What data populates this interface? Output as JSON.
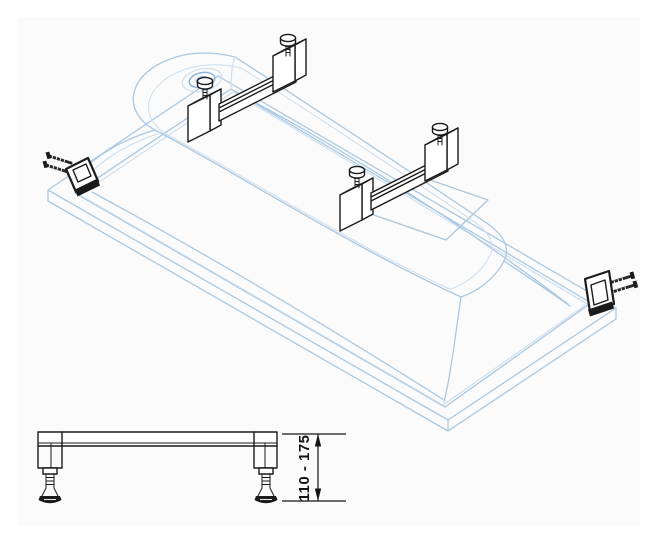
{
  "page": {
    "background": "#ffffff",
    "sheet-background": "#fbfbfb"
  },
  "colors": {
    "tub-line": "#a9c8e2",
    "tub-line-soft": "#cbdeef",
    "tub-line-strong": "#8fb6da",
    "hardware-line": "#1b1b1b",
    "dimension-line": "#151515"
  },
  "isometric_view": {
    "parts": [
      "inverted-bathtub-shell",
      "rim-flange",
      "drain-recess",
      "bottom-stand-area",
      "support-rail-head-end",
      "support-rail-foot-end",
      "rail-fixing-screws",
      "wall-anchor-bracket-left",
      "wall-anchor-bracket-right"
    ]
  },
  "side_view": {
    "parts": [
      "leveling-frame-profile",
      "adjustable-foot-left",
      "adjustable-foot-right"
    ],
    "dimension_label": "110 - 175"
  }
}
